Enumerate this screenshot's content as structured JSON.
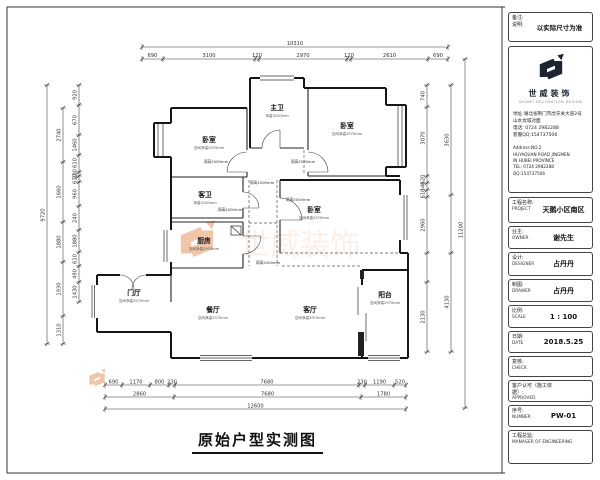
{
  "titleblock": {
    "note": {
      "label_a": "备注:",
      "label_b": "说明:",
      "text": "以实际尺寸为准"
    },
    "company": {
      "name": "世威装饰",
      "tagline": "SHIWEI DECORATION DESIGN",
      "addr1": "地址:湖北省荆门市虎牙关大道2号",
      "addr2": "山水龙城对面",
      "phone": "电话: 0724 2982288",
      "qq": "客服QQ:154737506",
      "en_addr1": "Address:NO.2",
      "en_addr2": "HUYAQUAN ROAD JINGMEN",
      "en_addr3": "IN HUBEI PROVINCE",
      "en_tel": "TEL: 0724 2982288",
      "en_qq": "QQ:154737506"
    },
    "fields": [
      {
        "cn": "工程名称:",
        "en": "PROJECT",
        "value": "天鹅小区南区"
      },
      {
        "cn": "业主:",
        "en": "OWNER",
        "value": "谢先生"
      },
      {
        "cn": "设计:",
        "en": "DESIGNER",
        "value": "占丹丹"
      },
      {
        "cn": "制图:",
        "en": "DRAWER",
        "value": "占丹丹"
      },
      {
        "cn": "比例:",
        "en": "SCALE",
        "value": "1 : 100"
      },
      {
        "cn": "日期:",
        "en": "DATE",
        "value": "2018.5.25"
      },
      {
        "cn": "复核:",
        "en": "CHECK",
        "value": ""
      },
      {
        "cn": "客户认可（施工依据）:",
        "en": "APPROVED",
        "value": ""
      },
      {
        "cn": "序号:",
        "en": "NUMBER",
        "value": "PW-01"
      },
      {
        "cn": "工程总监:",
        "en": "MANAGER OF ENGINEERING",
        "value": ""
      }
    ]
  },
  "plan": {
    "title": "原始户型实测图",
    "door_label": "洞高2000mm",
    "rooms": [
      {
        "name": "卧室",
        "note": "空间净高2970mm"
      },
      {
        "name": "主卫",
        "note": "净高3200mm"
      },
      {
        "name": "卧室",
        "note": "空间净高2970mm"
      },
      {
        "name": "客卫",
        "note": "净高3200mm"
      },
      {
        "name": "厨房",
        "note": "空间净高2970mm"
      },
      {
        "name": "卧室",
        "note": "空间净高2970mm"
      },
      {
        "name": "门厅",
        "note": "空间净高2970mm"
      },
      {
        "name": "餐厅",
        "note": "空间净高2970mm"
      },
      {
        "name": "客厅",
        "note": "空间净高2970mm"
      },
      {
        "name": "阳台",
        "note": "空间净高2970mm"
      }
    ],
    "dims": {
      "top": {
        "total": "10310",
        "segments": [
          "690",
          "3100",
          "120",
          "2970",
          "120",
          "2610",
          "690"
        ]
      },
      "left": {
        "total": "9720",
        "outer": [
          "2740",
          "1660",
          "1880",
          "1930",
          "1310"
        ],
        "inner": [
          "920",
          "670",
          "1460",
          "610",
          "280",
          "610",
          "960",
          "240",
          "1880",
          "610",
          "490",
          "1430"
        ]
      },
      "right": {
        "total": "11200",
        "outer": [
          "3630",
          "4130"
        ],
        "inner": [
          "740",
          "3070",
          "620",
          "340",
          "610",
          "2960",
          "2130"
        ]
      },
      "bottom": {
        "total": "12600",
        "row1": [
          "690",
          "1170",
          "800",
          "230",
          "7680",
          "230",
          "1190",
          "520"
        ],
        "row2": [
          "2860",
          "7680",
          "1780"
        ]
      }
    }
  },
  "watermark": {
    "text": "世威装饰"
  }
}
